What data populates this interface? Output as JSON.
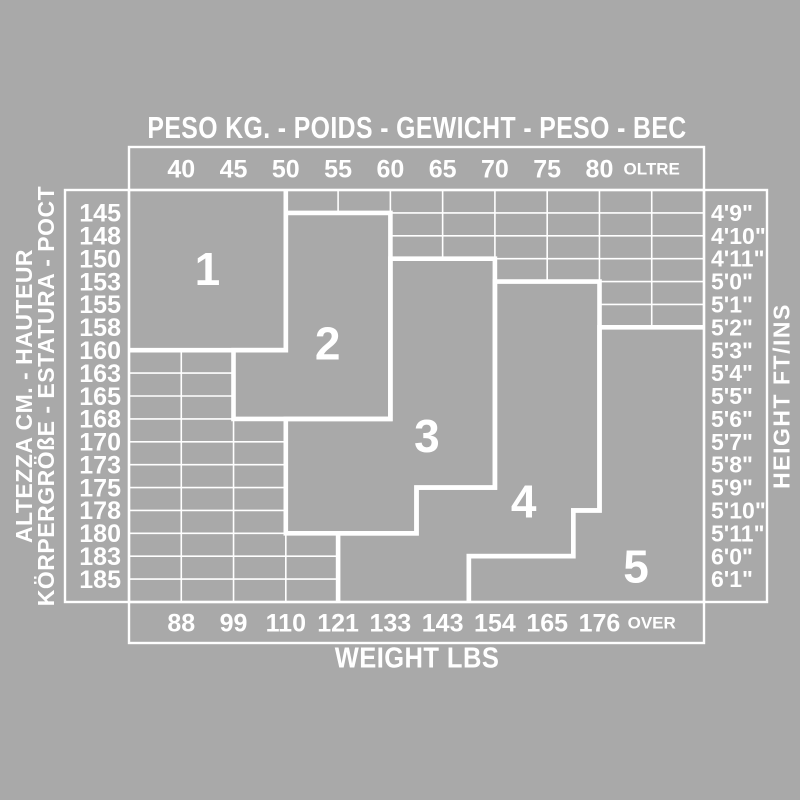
{
  "canvas": {
    "bg": "#A9A9A9",
    "fg": "#FFFFFF"
  },
  "chart_data": {
    "type": "heatmap",
    "description": "Size chart: size zones 1-5 over weight (x) vs height (y) grid; tick labels sit on internal grid lines",
    "top_axis": {
      "title": "PESO KG. - POIDS - GEWICHT - PESO - BEC",
      "ticks": [
        "40",
        "45",
        "50",
        "55",
        "60",
        "65",
        "70",
        "75",
        "80",
        "OLTRE"
      ]
    },
    "bottom_axis": {
      "title": "WEIGHT LBS",
      "ticks": [
        "88",
        "99",
        "110",
        "121",
        "133",
        "143",
        "154",
        "165",
        "176",
        "OVER"
      ]
    },
    "left_axis": {
      "title_lines": [
        "ALTEZZA CM. - HAUTEUR",
        "KÖRPERGRÖßE - ESTATURA - POCT"
      ],
      "ticks": [
        "145",
        "148",
        "150",
        "153",
        "155",
        "158",
        "160",
        "163",
        "165",
        "168",
        "170",
        "173",
        "175",
        "178",
        "180",
        "183",
        "185"
      ]
    },
    "right_axis": {
      "title": "HEIGHT FT/INS",
      "ticks": [
        "4'9\"",
        "4'10\"",
        "4'11\"",
        "5'0\"",
        "5'1\"",
        "5'2\"",
        "5'3\"",
        "5'4\"",
        "5'5\"",
        "5'6\"",
        "5'7\"",
        "5'8\"",
        "5'9\"",
        "5'10\"",
        "5'11\"",
        "6'0\"",
        "6'1\""
      ]
    },
    "grid": {
      "cols": 11,
      "rows": 18
    },
    "zones": [
      {
        "label": "1",
        "label_pos": [
          1.5,
          3.45
        ],
        "closed": false,
        "fill": [
          [
            0,
            0
          ],
          [
            3,
            0
          ],
          [
            3,
            7
          ],
          [
            0,
            7
          ]
        ],
        "border": [
          [
            0,
            7
          ],
          [
            3,
            7
          ],
          [
            3,
            0
          ]
        ]
      },
      {
        "label": "2",
        "label_pos": [
          3.8,
          6.7
        ],
        "closed": true,
        "fill": [
          [
            3,
            1
          ],
          [
            5,
            1
          ],
          [
            5,
            10
          ],
          [
            2,
            10
          ],
          [
            2,
            7
          ],
          [
            3,
            7
          ]
        ],
        "border": [
          [
            3,
            1
          ],
          [
            5,
            1
          ],
          [
            5,
            10
          ],
          [
            2,
            10
          ],
          [
            2,
            7
          ],
          [
            3,
            7
          ]
        ]
      },
      {
        "label": "3",
        "label_pos": [
          5.7,
          10.75
        ],
        "closed": true,
        "fill": [
          [
            5,
            3
          ],
          [
            7,
            3
          ],
          [
            7,
            13
          ],
          [
            5.5,
            13
          ],
          [
            5.5,
            15
          ],
          [
            3,
            15
          ],
          [
            3,
            10
          ],
          [
            5,
            10
          ]
        ],
        "border": [
          [
            5,
            3
          ],
          [
            7,
            3
          ],
          [
            7,
            13
          ],
          [
            5.5,
            13
          ],
          [
            5.5,
            15
          ],
          [
            3,
            15
          ],
          [
            3,
            10
          ],
          [
            5,
            10
          ]
        ]
      },
      {
        "label": "4",
        "label_pos": [
          7.55,
          13.6
        ],
        "closed": false,
        "fill": [
          [
            7,
            4
          ],
          [
            9,
            4
          ],
          [
            9,
            14
          ],
          [
            8.5,
            14
          ],
          [
            8.5,
            16
          ],
          [
            6.5,
            16
          ],
          [
            6.5,
            18
          ],
          [
            4,
            18
          ],
          [
            4,
            15
          ],
          [
            5.5,
            15
          ],
          [
            5.5,
            13
          ],
          [
            7,
            13
          ]
        ],
        "border": [
          [
            4,
            18
          ],
          [
            4,
            15
          ],
          [
            5.5,
            15
          ],
          [
            5.5,
            13
          ],
          [
            7,
            13
          ],
          [
            7,
            4
          ],
          [
            9,
            4
          ],
          [
            9,
            14
          ],
          [
            8.5,
            14
          ],
          [
            8.5,
            16
          ],
          [
            6.5,
            16
          ],
          [
            6.5,
            18
          ]
        ]
      },
      {
        "label": "5",
        "label_pos": [
          9.7,
          16.45
        ],
        "closed": false,
        "fill": [
          [
            9,
            6
          ],
          [
            11,
            6
          ],
          [
            11,
            18
          ],
          [
            6.5,
            18
          ],
          [
            6.5,
            16
          ],
          [
            8.5,
            16
          ],
          [
            8.5,
            14
          ],
          [
            9,
            14
          ]
        ],
        "border": [
          [
            11,
            6
          ],
          [
            9,
            6
          ],
          [
            9,
            14
          ],
          [
            8.5,
            14
          ],
          [
            8.5,
            16
          ],
          [
            6.5,
            16
          ],
          [
            6.5,
            18
          ]
        ]
      }
    ],
    "layout": {
      "grid_px": {
        "x0": 129,
        "x1": 704,
        "y0": 190,
        "y1": 602
      },
      "top_box_y": 147,
      "bottom_box_y": 643,
      "left_box_x": 65,
      "right_box_x": 767,
      "line_w_thin": 1.6,
      "line_w_box": 2.4,
      "line_w_zone": 4.6,
      "tick_font": 25,
      "tick_font_small": 17,
      "side_tick_font_left": 25,
      "side_tick_font_right": 23,
      "zone_font": 46
    }
  }
}
